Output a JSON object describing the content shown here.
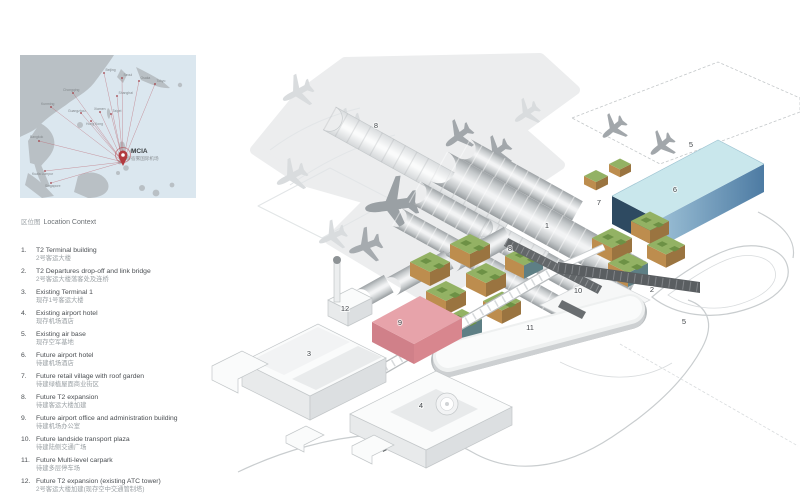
{
  "map": {
    "caption_zh": "区位图",
    "caption_en": "Location Context",
    "hub_code": "MCIA",
    "hub_name_zh": "宿雾国际机场",
    "cities": [
      {
        "label": "Beijing"
      },
      {
        "label": "Seoul"
      },
      {
        "label": "Osaka"
      },
      {
        "label": "Tokyo"
      },
      {
        "label": "Shanghai"
      },
      {
        "label": "Chongqing"
      },
      {
        "label": "Kunming"
      },
      {
        "label": "Taipei"
      },
      {
        "label": "Xiamen"
      },
      {
        "label": "Guangzhou"
      },
      {
        "label": "Hong Kong"
      },
      {
        "label": "Bangkok"
      },
      {
        "label": "Kuala Lumpur"
      },
      {
        "label": "Singapore"
      }
    ]
  },
  "legend": {
    "items": [
      {
        "num": "1.",
        "en": "T2 Terminal building",
        "zh": "2号客运大楼"
      },
      {
        "num": "2.",
        "en": "T2 Departures drop-off and link bridge",
        "zh": "2号客运大楼落客处及连桥"
      },
      {
        "num": "3.",
        "en": "Existing Terminal 1",
        "zh": "现存1号客运大楼"
      },
      {
        "num": "4.",
        "en": "Existing airport hotel",
        "zh": "现存机场酒店"
      },
      {
        "num": "5.",
        "en": "Existing air base",
        "zh": "现存空军基地"
      },
      {
        "num": "6.",
        "en": "Future airport hotel",
        "zh": "待建机场酒店"
      },
      {
        "num": "7.",
        "en": "Future retail village with roof garden",
        "zh": "待建绿植屋面商业街区"
      },
      {
        "num": "8.",
        "en": "Future T2 expansion",
        "zh": "待建客运大楼加建"
      },
      {
        "num": "9.",
        "en": "Future airport office and administration building",
        "zh": "待建机场办公室"
      },
      {
        "num": "10.",
        "en": "Future landside transport plaza",
        "zh": "待建陆侧交通广场"
      },
      {
        "num": "11.",
        "en": "Future Multi-level carpark",
        "zh": "待建多层停车场"
      },
      {
        "num": "12.",
        "en": "Future T2 expansion (existing ATC tower)",
        "zh": "2号客运大楼加建(现存空中交通管制塔)"
      }
    ]
  },
  "markers": [
    "1",
    "2",
    "3",
    "4",
    "5",
    "5",
    "6",
    "7",
    "8",
    "8",
    "9",
    "10",
    "11",
    "12"
  ],
  "colors": {
    "route_red": "#bb6570",
    "pin_red": "#b23a3f",
    "hotel_blue_top": "#c9e7ec",
    "retail_green": "#93b264",
    "office_pink": "#e7a3aa",
    "terminal_gray": "#c6cacc"
  }
}
